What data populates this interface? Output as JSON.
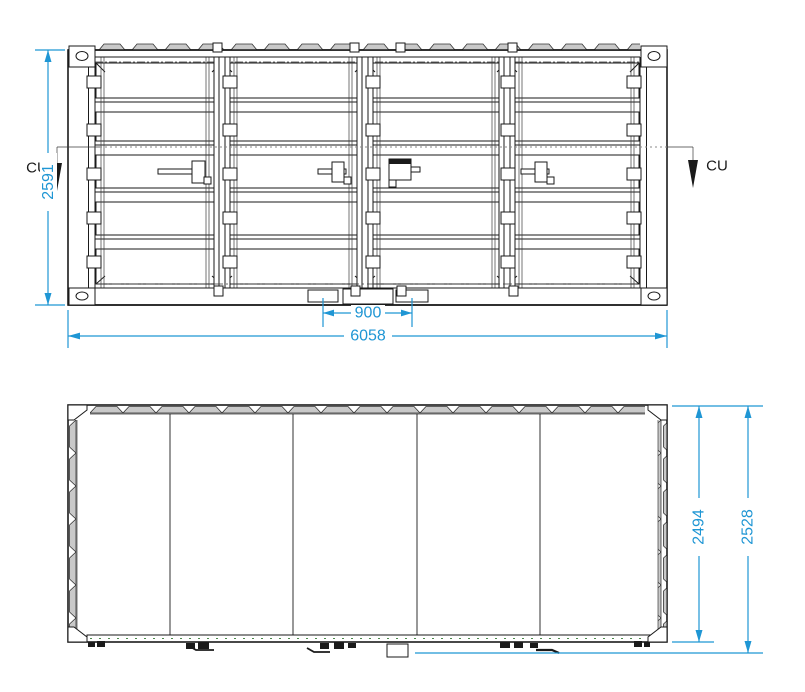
{
  "drawing": {
    "type": "container technical drawing, side elevation and plan view",
    "background_color": "#ffffff",
    "line_color": "#1a1a1a",
    "dimension_color": "#1f96d4",
    "cut_line_color": "#8a8a8a",
    "corrugation_fill": "#c9c9c9",
    "views": {
      "side_elevation": {
        "dimensions": {
          "height": "2591",
          "overall_length": "6058",
          "pocket_spacing": "900"
        },
        "section_markers": {
          "left_label": "CU",
          "right_label": "CU"
        }
      },
      "plan": {
        "dimensions": {
          "body_width": "2494",
          "overall_width": "2528"
        }
      }
    }
  }
}
